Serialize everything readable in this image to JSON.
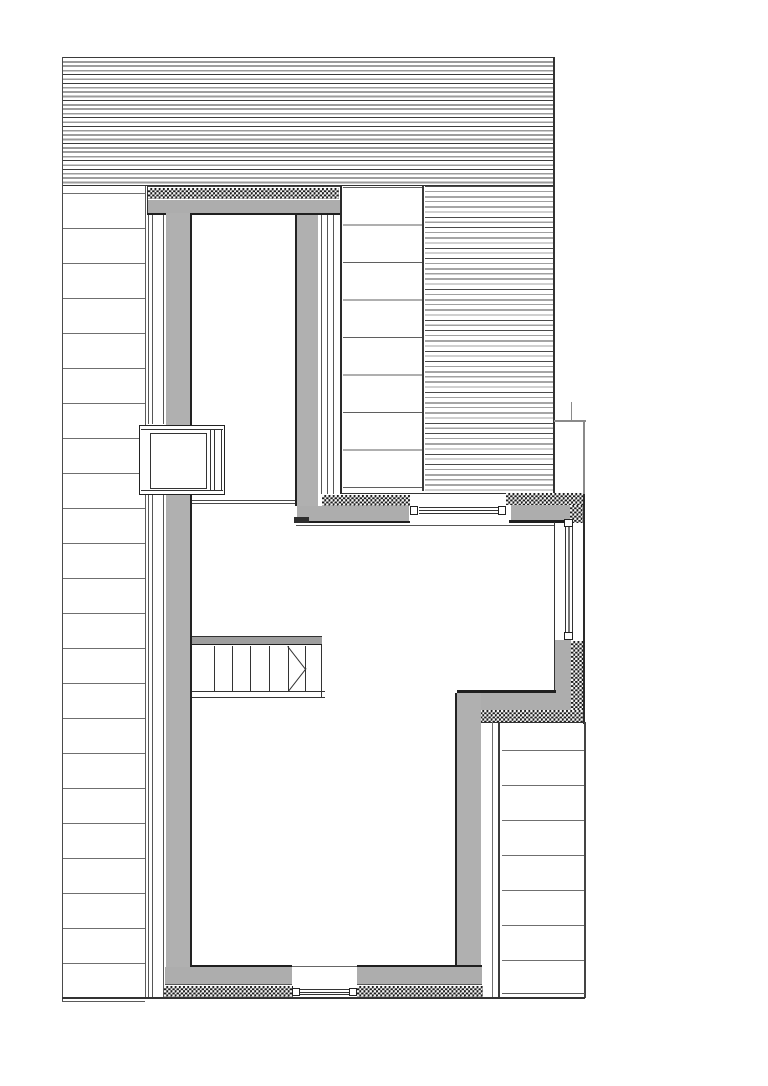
{
  "meta": {
    "drawing_type": "architectural-plan-detail",
    "canvas_width": 768,
    "canvas_height": 1086,
    "background": "#ffffff",
    "has_text": false
  },
  "palette": {
    "wall_fill": "#adadad",
    "stair_header_fill": "#9e9e9e",
    "dark_edge": "#1f1f1f",
    "medium_line": "#555555",
    "light_line": "#8a8a8a",
    "siding_line": "#6f6f6f",
    "insulation_checker": "#1b1b1b",
    "paper": "#ffffff"
  },
  "elements": [
    {
      "name": "roof-hatch-band",
      "type": "hatch-roof",
      "x": 62,
      "y": 57,
      "w": 492,
      "h": 129
    },
    {
      "name": "roof-band-bottom-line",
      "type": "line",
      "x": 62,
      "y": 185.3,
      "w": 491,
      "h": 1.2,
      "c": "#333333"
    },
    {
      "name": "facade-left-edge-line",
      "type": "line",
      "x": 62,
      "y": 57,
      "w": 1,
      "h": 945,
      "c": "#4a4a4a"
    },
    {
      "name": "left-siding-hatch",
      "type": "hlines35",
      "x": 63,
      "y": 193,
      "w": 82,
      "h": 806
    },
    {
      "name": "left-siding-right-edge-line",
      "type": "line",
      "x": 144.5,
      "y": 186,
      "w": 1,
      "h": 812,
      "c": "#5a5a5a"
    },
    {
      "name": "left-siding-bottom-line",
      "type": "line",
      "x": 62,
      "y": 1001,
      "w": 83,
      "h": 1,
      "c": "#5a5a5a"
    },
    {
      "name": "roof-section-upper-hatch",
      "type": "hlines37",
      "x": 343,
      "y": 187,
      "w": 79,
      "h": 301
    },
    {
      "name": "roof-section-upper-right-edge",
      "type": "line",
      "x": 422,
      "y": 186,
      "w": 2.4,
      "h": 305,
      "c": "#3a3a3a"
    },
    {
      "name": "roof-section-lower-hatch",
      "type": "hatch-fine",
      "x": 425,
      "y": 186,
      "w": 128,
      "h": 308
    },
    {
      "name": "roof-ridge-edge-line",
      "type": "line",
      "x": 553,
      "y": 57,
      "w": 1.5,
      "h": 437,
      "c": "#333333"
    },
    {
      "name": "dormer-head-top-line",
      "type": "line",
      "x": 146.5,
      "y": 186,
      "w": 195,
      "h": 1.3,
      "c": "#444444"
    },
    {
      "name": "dormer-head-left-edge-line",
      "type": "line",
      "x": 146.5,
      "y": 186,
      "w": 1,
      "h": 29,
      "c": "#333333"
    },
    {
      "name": "dormer-head-insulation",
      "type": "checker",
      "x": 148,
      "y": 188,
      "w": 191,
      "h": 11
    },
    {
      "name": "dormer-head-gray",
      "type": "rect",
      "x": 147.5,
      "y": 199.5,
      "w": 193,
      "h": 13.5,
      "c": "#adadad"
    },
    {
      "name": "dormer-head-bottom-line",
      "type": "line",
      "x": 147,
      "y": 213,
      "w": 194,
      "h": 2.2,
      "c": "#1f1f1f"
    },
    {
      "name": "west-wall-sheathing-line-1a",
      "type": "line",
      "x": 147.5,
      "y": 215,
      "w": 1,
      "h": 209,
      "c": "#565656"
    },
    {
      "name": "west-wall-sheathing-line-2a",
      "type": "line",
      "x": 151.5,
      "y": 215,
      "w": 1,
      "h": 209,
      "c": "#565656"
    },
    {
      "name": "west-wall-sheathing-line-3a",
      "type": "line",
      "x": 162.5,
      "y": 215,
      "w": 1,
      "h": 209,
      "c": "#565656"
    },
    {
      "name": "west-wall-sheathing-line-1b",
      "type": "line",
      "x": 147.5,
      "y": 495,
      "w": 1,
      "h": 502,
      "c": "#565656"
    },
    {
      "name": "west-wall-sheathing-line-2b",
      "type": "line",
      "x": 151.5,
      "y": 495,
      "w": 1,
      "h": 502,
      "c": "#565656"
    },
    {
      "name": "west-wall-sheathing-line-3b",
      "type": "line",
      "x": 162.5,
      "y": 495,
      "w": 1,
      "h": 502,
      "c": "#565656"
    },
    {
      "name": "west-wall-gray-upper",
      "type": "rect",
      "x": 165.5,
      "y": 213,
      "w": 24.5,
      "h": 212,
      "c": "#b0b0b0"
    },
    {
      "name": "west-wall-gray-lower",
      "type": "rect",
      "x": 165.5,
      "y": 494,
      "w": 24.5,
      "h": 473,
      "c": "#b0b0b0"
    },
    {
      "name": "west-wall-inner-face-upper",
      "type": "line",
      "x": 189.5,
      "y": 213,
      "w": 2,
      "h": 212,
      "c": "#222222"
    },
    {
      "name": "west-wall-inner-face-lower",
      "type": "line",
      "x": 189.5,
      "y": 494,
      "w": 2,
      "h": 473,
      "c": "#222222"
    },
    {
      "name": "dormer-east-wall-inner-face",
      "type": "line",
      "x": 295,
      "y": 213,
      "w": 2,
      "h": 293,
      "c": "#222222"
    },
    {
      "name": "dormer-east-wall-gray",
      "type": "rect",
      "x": 297,
      "y": 215,
      "w": 21,
      "h": 291,
      "c": "#b0b0b0"
    },
    {
      "name": "dormer-east-wall-sheathing-1",
      "type": "line",
      "x": 320.5,
      "y": 215,
      "w": 1,
      "h": 279,
      "c": "#565656"
    },
    {
      "name": "dormer-east-wall-sheathing-2",
      "type": "line",
      "x": 326.5,
      "y": 215,
      "w": 1,
      "h": 279,
      "c": "#565656"
    },
    {
      "name": "dormer-east-wall-sheathing-3",
      "type": "line",
      "x": 333,
      "y": 215,
      "w": 1,
      "h": 279,
      "c": "#565656"
    },
    {
      "name": "dormer-east-wall-outer-edge",
      "type": "line",
      "x": 340,
      "y": 186,
      "w": 1.8,
      "h": 308,
      "c": "#2a2a2a"
    },
    {
      "name": "ceiling-break-line-1",
      "type": "line",
      "x": 192,
      "y": 500,
      "w": 103,
      "h": 1,
      "c": "#4a4a4a"
    },
    {
      "name": "ceiling-break-line-2",
      "type": "line",
      "x": 192,
      "y": 503,
      "w": 103,
      "h": 1,
      "c": "#4a4a4a"
    },
    {
      "name": "west-window-box",
      "type": "framefill",
      "x": 139,
      "y": 424.5,
      "w": 85.5,
      "h": 70,
      "bw": 1.5,
      "bc": "#222222",
      "fill": "#ffffff"
    },
    {
      "name": "west-window-box-top-line",
      "type": "line",
      "x": 141,
      "y": 428.5,
      "w": 82,
      "h": 1,
      "c": "#333333"
    },
    {
      "name": "west-window-box-bottom-line",
      "type": "line",
      "x": 141,
      "y": 489.5,
      "w": 82,
      "h": 1,
      "c": "#333333"
    },
    {
      "name": "west-window-inner-pane",
      "type": "framefill",
      "x": 150,
      "y": 433,
      "w": 57,
      "h": 56,
      "bw": 1,
      "bc": "#333333",
      "fill": "#ffffff"
    },
    {
      "name": "west-window-frame-line-1",
      "type": "line",
      "x": 209.5,
      "y": 429,
      "w": 1,
      "h": 61,
      "c": "#333333"
    },
    {
      "name": "west-window-frame-line-2",
      "type": "line",
      "x": 213.5,
      "y": 429,
      "w": 1,
      "h": 61,
      "c": "#333333"
    },
    {
      "name": "west-window-frame-line-3",
      "type": "line",
      "x": 220.8,
      "y": 429,
      "w": 1,
      "h": 61,
      "c": "#333333"
    },
    {
      "name": "south-band-outer-line",
      "type": "line",
      "x": 341,
      "y": 493.2,
      "w": 242,
      "h": 1.2,
      "c": "#333333"
    },
    {
      "name": "south-band-insulation-west",
      "type": "checker",
      "x": 322,
      "y": 494.8,
      "w": 88,
      "h": 11
    },
    {
      "name": "south-band-gray-west",
      "type": "rect",
      "x": 296.5,
      "y": 505.8,
      "w": 112,
      "h": 15,
      "c": "#adadad"
    },
    {
      "name": "south-band-west-bottom-line",
      "type": "line",
      "x": 294,
      "y": 520.6,
      "w": 116,
      "h": 2.4,
      "c": "#1f1f1f"
    },
    {
      "name": "south-band-corner-block",
      "type": "rect",
      "x": 294,
      "y": 517.3,
      "w": 15,
      "h": 5.6,
      "c": "#2e2e2e"
    },
    {
      "name": "clerestory-sill-line",
      "type": "line",
      "x": 296,
      "y": 524.8,
      "w": 258.5,
      "h": 1,
      "c": "#555555"
    },
    {
      "name": "clerestory-jamb-west",
      "type": "framefill",
      "x": 409.5,
      "y": 505.5,
      "w": 8.5,
      "h": 9.5,
      "bw": 1,
      "bc": "#222222",
      "fill": "#ffffff"
    },
    {
      "name": "clerestory-jamb-east",
      "type": "framefill",
      "x": 497.5,
      "y": 505.5,
      "w": 8.5,
      "h": 9.5,
      "bw": 1,
      "bc": "#222222",
      "fill": "#ffffff"
    },
    {
      "name": "clerestory-glazing-1",
      "type": "line",
      "x": 418.5,
      "y": 507.3,
      "w": 79.5,
      "h": 1,
      "c": "#333333"
    },
    {
      "name": "clerestory-glazing-2",
      "type": "line",
      "x": 418.5,
      "y": 510.1,
      "w": 79.5,
      "h": 1.4,
      "c": "#333333"
    },
    {
      "name": "clerestory-glazing-3",
      "type": "line",
      "x": 418.5,
      "y": 513.3,
      "w": 79.5,
      "h": 1,
      "c": "#333333"
    },
    {
      "name": "south-band-insulation-east",
      "type": "checker",
      "x": 506,
      "y": 492.8,
      "w": 77,
      "h": 12.6
    },
    {
      "name": "south-band-gray-east",
      "type": "rect",
      "x": 511,
      "y": 505.4,
      "w": 59,
      "h": 15.4,
      "c": "#adadad"
    },
    {
      "name": "south-band-east-bottom-line",
      "type": "line",
      "x": 508.5,
      "y": 520.4,
      "w": 62,
      "h": 2.4,
      "c": "#1f1f1f"
    },
    {
      "name": "south-band-insulation-return",
      "type": "checker",
      "x": 570,
      "y": 505.4,
      "w": 13,
      "h": 18
    },
    {
      "name": "east-outline-top-line",
      "type": "line",
      "x": 554,
      "y": 420.3,
      "w": 31.5,
      "h": 1.6,
      "c": "#8a8a8a"
    },
    {
      "name": "east-outline-stub-line",
      "type": "line",
      "x": 571,
      "y": 402,
      "w": 1.2,
      "h": 18.5,
      "c": "#8a8a8a"
    },
    {
      "name": "east-outer-face-upper",
      "type": "line",
      "x": 583.2,
      "y": 420.5,
      "w": 1.6,
      "h": 74,
      "c": "#8a8a8a"
    },
    {
      "name": "east-outer-face",
      "type": "line",
      "x": 582.8,
      "y": 494,
      "w": 2,
      "h": 229.5,
      "c": "#2a2a2a"
    },
    {
      "name": "east-inner-face-line",
      "type": "line",
      "x": 553.5,
      "y": 522,
      "w": 1.6,
      "h": 171,
      "c": "#333333"
    },
    {
      "name": "east-window-jamb-top",
      "type": "framefill",
      "x": 563.5,
      "y": 518.5,
      "w": 9.5,
      "h": 8.7,
      "bw": 1,
      "bc": "#222222",
      "fill": "#ffffff"
    },
    {
      "name": "east-window-jamb-bottom",
      "type": "framefill",
      "x": 563.5,
      "y": 631.6,
      "w": 9.5,
      "h": 8.7,
      "bw": 1,
      "bc": "#222222",
      "fill": "#ffffff"
    },
    {
      "name": "east-window-glazing-1",
      "type": "line",
      "x": 565.3,
      "y": 527.2,
      "w": 1,
      "h": 104.5,
      "c": "#333333"
    },
    {
      "name": "east-window-glazing-2",
      "type": "line",
      "x": 568.2,
      "y": 527.2,
      "w": 1.4,
      "h": 104.5,
      "c": "#777777"
    },
    {
      "name": "east-window-glazing-3",
      "type": "line",
      "x": 571.5,
      "y": 527.2,
      "w": 1,
      "h": 104.5,
      "c": "#333333"
    },
    {
      "name": "se-wall-gray-vertical",
      "type": "rect",
      "x": 555.2,
      "y": 640.3,
      "w": 15.8,
      "h": 70,
      "c": "#adadad"
    },
    {
      "name": "se-wall-insulation-vertical",
      "type": "checker",
      "x": 571,
      "y": 641,
      "w": 12,
      "h": 81.5
    },
    {
      "name": "se-wall-inner-corner-line",
      "type": "line",
      "x": 456.5,
      "y": 690.2,
      "w": 99.5,
      "h": 2.5,
      "c": "#1f1f1f"
    },
    {
      "name": "se-wall-gray-horizontal",
      "type": "rect",
      "x": 458,
      "y": 692.7,
      "w": 113,
      "h": 17.3,
      "c": "#adadad"
    },
    {
      "name": "se-wall-insulation-horizontal",
      "type": "checker",
      "x": 480,
      "y": 710,
      "w": 103,
      "h": 12.3
    },
    {
      "name": "se-wall-outer-bottom-line",
      "type": "line",
      "x": 480,
      "y": 722.2,
      "w": 105,
      "h": 1.3,
      "c": "#333333"
    },
    {
      "name": "se-corner-mark",
      "type": "rect",
      "x": 455.5,
      "y": 719,
      "w": 6.5,
      "h": 4.3,
      "c": "#2a2a2a"
    },
    {
      "name": "east-wall-inner-face",
      "type": "line",
      "x": 455.2,
      "y": 693,
      "w": 2.2,
      "h": 274,
      "c": "#222222"
    },
    {
      "name": "east-wall-gray",
      "type": "rect",
      "x": 457.4,
      "y": 693,
      "w": 23.2,
      "h": 274,
      "c": "#b0b0b0"
    },
    {
      "name": "east-wall-sheathing-line-1",
      "type": "line",
      "x": 492.3,
      "y": 722,
      "w": 1,
      "h": 275,
      "c": "#6f6f6f"
    },
    {
      "name": "east-wall-sheathing-line-2",
      "type": "line",
      "x": 498,
      "y": 722,
      "w": 2,
      "h": 275,
      "c": "#3c3c3c"
    },
    {
      "name": "right-siding-hatch",
      "type": "hlines35",
      "x": 502,
      "y": 750,
      "w": 83,
      "h": 215
    },
    {
      "name": "right-siding-right-edge-line",
      "type": "line",
      "x": 584.3,
      "y": 722,
      "w": 1.4,
      "h": 276,
      "c": "#444444"
    },
    {
      "name": "right-siding-bottom-line",
      "type": "line",
      "x": 502,
      "y": 993,
      "w": 83,
      "h": 1,
      "c": "#5a5a5a"
    },
    {
      "name": "south-wall-head-line-west",
      "type": "line",
      "x": 191,
      "y": 965,
      "w": 101,
      "h": 2,
      "c": "#1f1f1f"
    },
    {
      "name": "south-wall-head-line-east",
      "type": "line",
      "x": 357,
      "y": 965,
      "w": 124.5,
      "h": 2,
      "c": "#1f1f1f"
    },
    {
      "name": "south-door-head-line",
      "type": "line",
      "x": 292,
      "y": 966,
      "w": 65,
      "h": 0.8,
      "c": "#666666"
    },
    {
      "name": "south-wall-gray-west",
      "type": "rect",
      "x": 165,
      "y": 967,
      "w": 127,
      "h": 17,
      "c": "#adadad"
    },
    {
      "name": "south-wall-gray-east",
      "type": "rect",
      "x": 357,
      "y": 967,
      "w": 124.5,
      "h": 17,
      "c": "#adadad"
    },
    {
      "name": "south-wall-mid-line-west",
      "type": "line",
      "x": 165,
      "y": 984.2,
      "w": 127,
      "h": 1,
      "c": "#555555"
    },
    {
      "name": "south-wall-mid-line-east",
      "type": "line",
      "x": 357,
      "y": 984.2,
      "w": 124.5,
      "h": 1,
      "c": "#555555"
    },
    {
      "name": "south-wall-insulation-west",
      "type": "checker",
      "x": 163.5,
      "y": 986,
      "w": 129,
      "h": 11
    },
    {
      "name": "south-wall-insulation-east",
      "type": "checker",
      "x": 357,
      "y": 986,
      "w": 126,
      "h": 11
    },
    {
      "name": "south-door-jamb-west",
      "type": "framefill",
      "x": 291.5,
      "y": 987.5,
      "w": 8,
      "h": 8.7,
      "bw": 1,
      "bc": "#222222",
      "fill": "#ffffff"
    },
    {
      "name": "south-door-jamb-east",
      "type": "framefill",
      "x": 348.8,
      "y": 987.5,
      "w": 8,
      "h": 8.7,
      "bw": 1,
      "bc": "#222222",
      "fill": "#ffffff"
    },
    {
      "name": "south-door-sill-line-1",
      "type": "line",
      "x": 299.5,
      "y": 989.3,
      "w": 49.5,
      "h": 1,
      "c": "#333333"
    },
    {
      "name": "south-door-sill-line-2",
      "type": "line",
      "x": 299.5,
      "y": 991.8,
      "w": 49.5,
      "h": 1.4,
      "c": "#333333"
    },
    {
      "name": "south-door-sill-line-3",
      "type": "line",
      "x": 299.5,
      "y": 994.4,
      "w": 49.5,
      "h": 1,
      "c": "#333333"
    },
    {
      "name": "south-outer-base-line",
      "type": "line",
      "x": 62,
      "y": 997.2,
      "w": 523,
      "h": 1.5,
      "c": "#333333"
    },
    {
      "name": "stair-header-top-line",
      "type": "line",
      "x": 192,
      "y": 635.5,
      "w": 130,
      "h": 1.3,
      "c": "#333333"
    },
    {
      "name": "stair-header-gray",
      "type": "rect",
      "x": 192,
      "y": 637,
      "w": 130,
      "h": 6.6,
      "c": "#9e9e9e"
    },
    {
      "name": "stair-header-bottom-line",
      "type": "line",
      "x": 192,
      "y": 643.6,
      "w": 130,
      "h": 1.7,
      "c": "#1f1f1f"
    },
    {
      "name": "stair-riser-1",
      "type": "line",
      "x": 213.5,
      "y": 646,
      "w": 1,
      "h": 45,
      "c": "#333333"
    },
    {
      "name": "stair-riser-2",
      "type": "line",
      "x": 231.5,
      "y": 646,
      "w": 1,
      "h": 45,
      "c": "#333333"
    },
    {
      "name": "stair-riser-3",
      "type": "line",
      "x": 250,
      "y": 646,
      "w": 1,
      "h": 45,
      "c": "#333333"
    },
    {
      "name": "stair-riser-4",
      "type": "line",
      "x": 268.8,
      "y": 646,
      "w": 1,
      "h": 45,
      "c": "#333333"
    },
    {
      "name": "stair-riser-5",
      "type": "line",
      "x": 287.5,
      "y": 646,
      "w": 1,
      "h": 45,
      "c": "#333333"
    },
    {
      "name": "stair-riser-6",
      "type": "line",
      "x": 304.5,
      "y": 646,
      "w": 1,
      "h": 45,
      "c": "#333333"
    },
    {
      "name": "stair-right-edge-line",
      "type": "line",
      "x": 320.8,
      "y": 645,
      "w": 1.2,
      "h": 53,
      "c": "#333333"
    },
    {
      "name": "stair-break-line-upper",
      "type": "diag",
      "x": 288,
      "y": 645.8,
      "len": 28.6,
      "deg": 52.1,
      "c": "#333333"
    },
    {
      "name": "stair-break-line-lower",
      "type": "diag",
      "x": 288,
      "y": 691,
      "len": 28.6,
      "deg": -52.1,
      "c": "#333333"
    },
    {
      "name": "stair-nosing-top-line",
      "type": "line",
      "x": 192,
      "y": 690.5,
      "w": 133,
      "h": 1.2,
      "c": "#333333"
    },
    {
      "name": "stair-nosing-bottom-line",
      "type": "line",
      "x": 192,
      "y": 696.8,
      "w": 133,
      "h": 1.3,
      "c": "#333333"
    }
  ]
}
